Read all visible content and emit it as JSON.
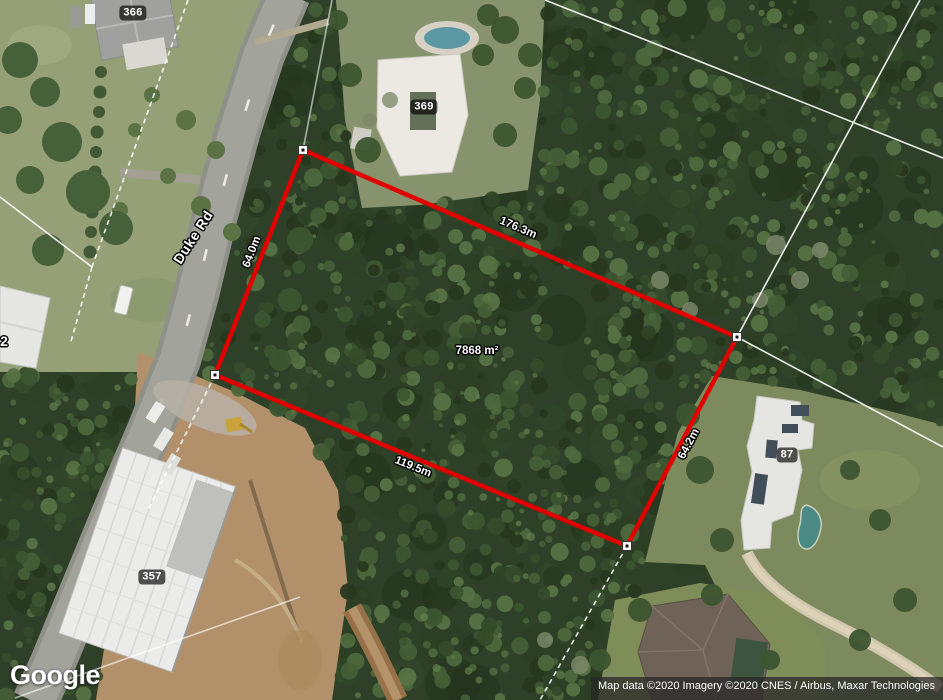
{
  "map_type": "satellite",
  "road": {
    "label": "Duke Rd"
  },
  "parcel_badges": [
    {
      "id": "p366",
      "label": "366"
    },
    {
      "id": "p369",
      "label": "369"
    },
    {
      "id": "p357",
      "label": "357"
    },
    {
      "id": "p87",
      "label": "87"
    }
  ],
  "street_numbers": [
    {
      "id": "n2",
      "label": "2"
    }
  ],
  "measurement": {
    "area_label": "7868 m²",
    "edge_labels": [
      {
        "id": "edge-top",
        "label": "176.3m"
      },
      {
        "id": "edge-right",
        "label": "64.2m"
      },
      {
        "id": "edge-bottom",
        "label": "119.5m"
      },
      {
        "id": "edge-left",
        "label": "64.0m"
      }
    ],
    "vertex_count": 4,
    "outline_color": "#e10000"
  },
  "branding": {
    "logo": "Google"
  },
  "attribution": {
    "text": "Map data ©2020 Imagery ©2020 CNES / Airbus, Maxar Technologies"
  },
  "colors": {
    "measure_red": "#e10000",
    "cadastral_line": "#ffffff",
    "badge_bg": "rgba(0,0,0,0.66)",
    "forest_dark": "#2e4128",
    "lawn": "#95a077",
    "dirt": "#b2906a",
    "road": "#a2a39a"
  }
}
